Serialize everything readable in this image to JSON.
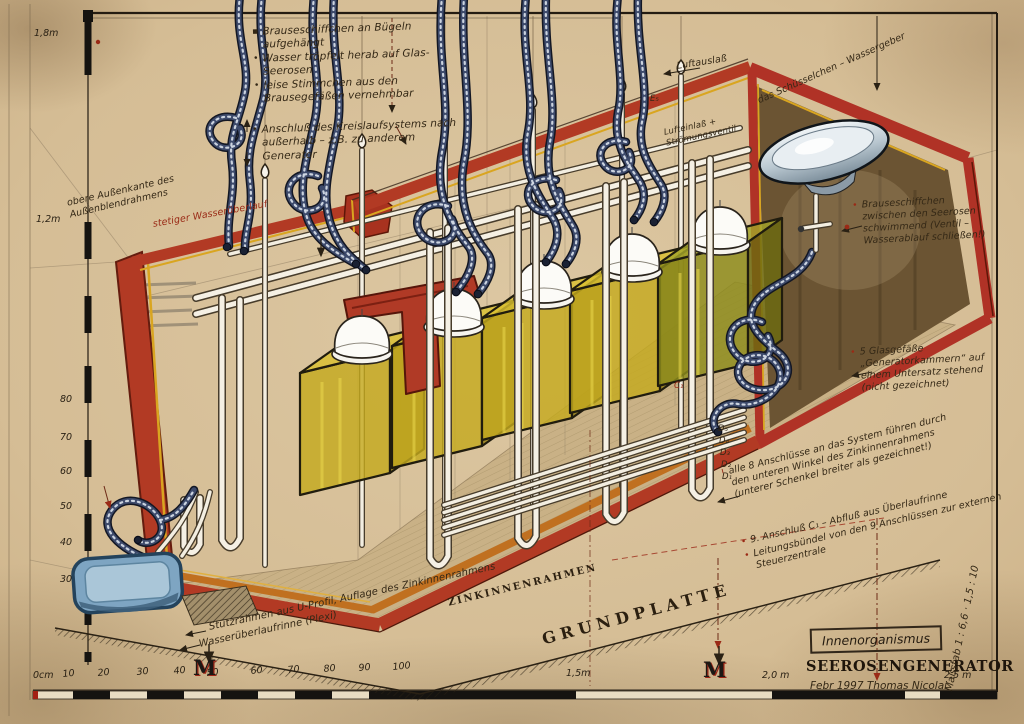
{
  "glyphs": {
    "bullet": "•",
    "sq_bullet": "▪",
    "excl": "!",
    "arrow": "↓"
  },
  "annotations": {
    "top_left": {
      "line1": "Brauseschiffchen an Bügeln aufgehängt",
      "line2": "Wasser tröpfelt herab auf Glas-Seerosen",
      "line3": "leise Stimmchen aus den Brausegefäßen vernehmbar",
      "line4": "Anschluß des Kreislaufsystems nach außerhalb – z.B. zu anderem Generator"
    },
    "left": {
      "outer_edge": "obere Außenkante des Außenblendrahmens",
      "overflow": "stetiger Wasserüberlauf"
    },
    "top_right": {
      "air_outlet": "Luftauslaß",
      "e5": "E₅",
      "inlet_valve": "Lufteinlaß + Strömungsventil",
      "bowl": "das Schüsselchen – Wassergeber"
    },
    "right": {
      "floating": "Brauseschiffchen zwischen den Seerosen schwimmend (Ventil – Wasserablauf schließen!)",
      "vessels": "5 Glasgefäße „Generatorkammern“ auf einem Untersatz stehend (nicht gezeichnet)"
    },
    "bottom_right": {
      "connections": "alle 8 Anschlüsse an das System führen durch den unteren Winkel des Zinkinnenrahmens (unterer Schenkel breiter als gezeichnet!)",
      "ninth": "9. Anschluß C₁ – Abfluß aus Überlaufrinne",
      "bundle": "Leitungsbündel von den 9 Anschlüssen zur externen Steuerzentrale"
    },
    "bottom": {
      "zinc": "ZINKINNENRAHMEN",
      "ground": "GRUNDPLATTE",
      "support": "Stützrahmen aus U-Profil, Auflage des Zinkinnenrahmens",
      "gutter": "Wasserüberlaufrinne (Plexi)"
    },
    "small_labels": {
      "c1": "C₁",
      "d5": "D₅",
      "d4": "D₄",
      "d3": "D₃",
      "d2": "D₂",
      "d1": "D₁"
    }
  },
  "title_block": {
    "box": "Innenorganismus",
    "title": "SEEROSENGENERATOR",
    "date_author": "Febr 1997   Thomas Nicolai",
    "scale": "Maßstab 1 : 6,6  ·  1,5 : 10"
  },
  "rulers": {
    "bottom": [
      "0cm",
      "10",
      "20",
      "30",
      "40",
      "50",
      "60",
      "70",
      "80",
      "90",
      "100",
      "1,5m",
      "2,0 m",
      "2,5 m"
    ],
    "left": [
      "1,8m",
      "1,2m",
      "80",
      "70",
      "60",
      "50",
      "40",
      "30"
    ],
    "marker": "M"
  },
  "colors": {
    "paper": "#d5bd95",
    "frame_red": "#b03226",
    "trim_gold": "#d9a520",
    "chamber_yellow": "#c4aa1e",
    "chamber5_green": "#8e8c1c",
    "hose_blue": "#3d4a6b",
    "pipe_white": "#f5f0e4",
    "zinc_orange": "#c07020",
    "tray_blue": "#7ea5c2",
    "ink": "#342816",
    "red_ink": "#9a2a16"
  }
}
